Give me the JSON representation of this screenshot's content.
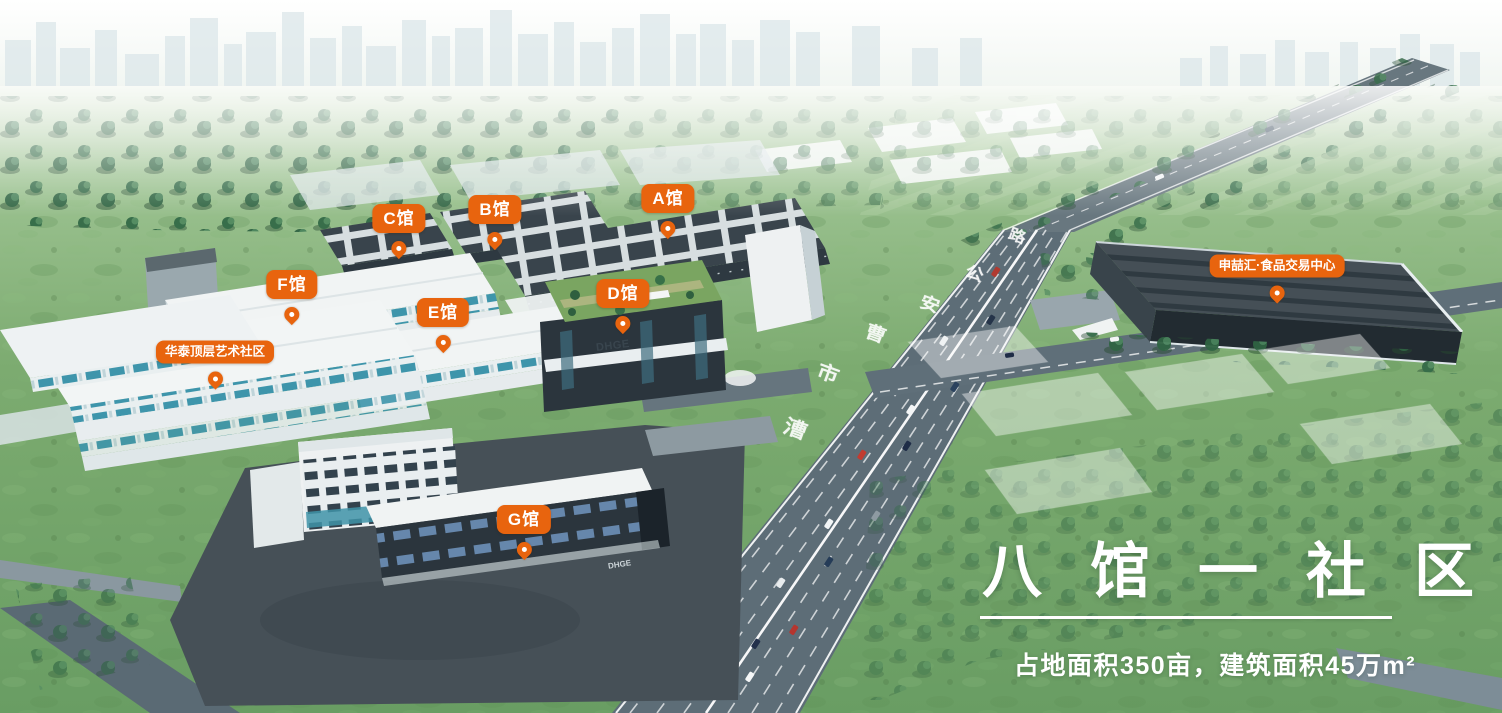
{
  "pins": [
    {
      "id": "hall-a",
      "label": "A馆"
    },
    {
      "id": "hall-b",
      "label": "B馆"
    },
    {
      "id": "hall-c",
      "label": "C馆"
    },
    {
      "id": "hall-d",
      "label": "D馆"
    },
    {
      "id": "hall-e",
      "label": "E馆"
    },
    {
      "id": "hall-f",
      "label": "F馆"
    },
    {
      "id": "hall-g",
      "label": "G馆"
    },
    {
      "id": "huatai-art-community",
      "label": "华泰顶层艺术社区"
    },
    {
      "id": "food-trade-center",
      "label": "申喆汇·食品交易中心"
    }
  ],
  "road": {
    "name": "曹安公路",
    "chars": [
      "路",
      "公",
      "安",
      "曹",
      "市",
      "漕"
    ]
  },
  "signs": {
    "d_hall": "DHGE",
    "g_hall": "DHGE"
  },
  "overlay": {
    "headline": "八馆一社区",
    "subline": "占地面积350亩，建筑面积45万m²"
  },
  "colors": {
    "accent": "#E8640E",
    "road": "#5D6D77",
    "grass": "#6FA068",
    "white_building": "#F1F4F4",
    "dark_roof": "#39444C"
  }
}
